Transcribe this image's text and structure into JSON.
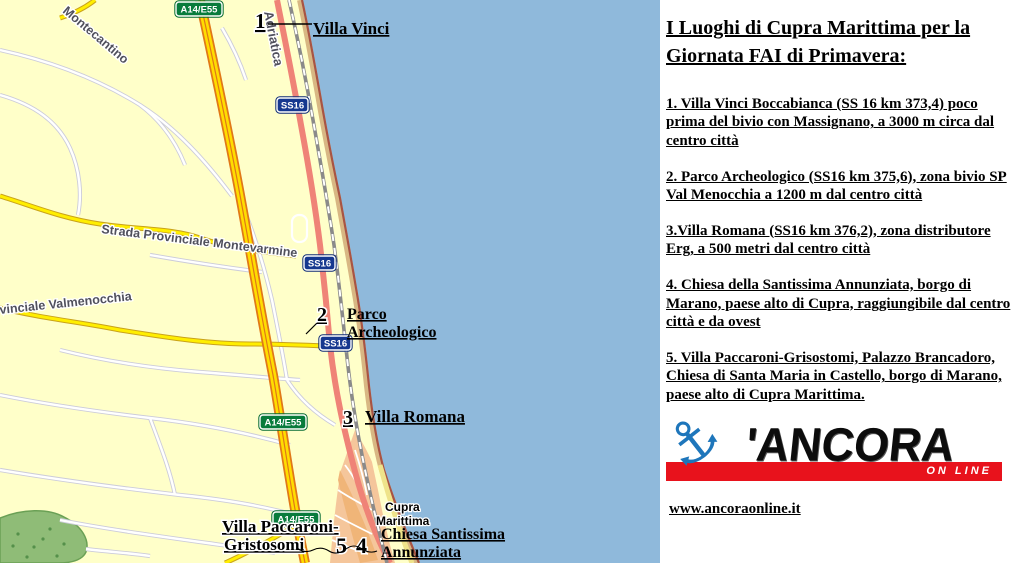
{
  "map": {
    "badges": {
      "a14": "A14/E55",
      "ss16": "SS16"
    },
    "streets": {
      "montecantino": "Montecantino",
      "adriatica": "Adriatica",
      "montevarmine": "Strada Provinciale Montevarmine",
      "valmenocchia": "vinciale Valmenocchia"
    },
    "markers": {
      "n1": "1",
      "n2": "2",
      "n3": "3",
      "n4": "4",
      "n5": "5"
    },
    "poi": {
      "villa_vinci": "Villa Vinci",
      "parco_line1": "Parco",
      "parco_line2": "Archeologico",
      "villa_romana": "Villa Romana",
      "paccaroni_line1": "Villa Paccaroni-",
      "paccaroni_line2": "Gristosomi",
      "chiesa_line1": "Chiesa Santissima",
      "chiesa_line2": "Annunziata",
      "town_line1": "Cupra",
      "town_line2": "Marittima"
    },
    "colors": {
      "sea": "#8fb9db",
      "land": "#ffffc9",
      "motorway": "#ffdd00",
      "motorway_casing": "#e07818",
      "ss16_road": "#ef8377",
      "badge_green": "#087b3c",
      "badge_navy": "#16388f",
      "park_green": "#8fbc77",
      "town_fill": "#f5c69b"
    }
  },
  "panel": {
    "title_line1": "I Luoghi di Cupra Marittima per la",
    "title_line2": "Giornata FAI di Primavera:",
    "items": [
      "1. Villa Vinci Boccabianca (SS 16 km 373,4) poco prima del bivio con Massignano, a 3000 m circa dal centro città",
      "2. Parco Archeologico (SS16 km 375,6), zona bivio SP Val Menocchia a 1200 m dal centro città",
      "3.Villa Romana (SS16 km 376,2), zona distributore Erg, a 500 metri dal centro città",
      "4. Chiesa della Santissima Annunziata, borgo di Marano, paese alto di Cupra, raggiungibile dal centro città e da ovest",
      "5. Villa Paccaroni-Grisostomi, Palazzo Brancadoro, Chiesa di Santa Maria in Castello, borgo di Marano, paese alto di Cupra Marittima."
    ],
    "logo": {
      "anchor_icon": "⚓",
      "wordmark": "'ANCORA",
      "tagline": "ON LINE"
    },
    "website": "www.ancoraonline.it"
  }
}
